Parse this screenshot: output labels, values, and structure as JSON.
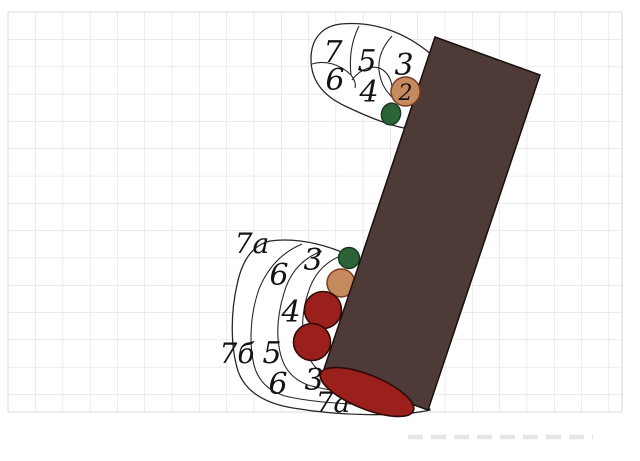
{
  "canvas": {
    "width": 640,
    "height": 461
  },
  "colors": {
    "paper": "#ffffff",
    "grid_line": "#d9d9db",
    "figure_outline": "#2b2625",
    "rectangle_fill": "#4e3a37",
    "red_fill": "#9b1f1a",
    "tan_fill": "#c58a5e",
    "green_fill": "#2c6337",
    "label_ink": "#151312",
    "watermark": "#e6e6e6"
  },
  "top_diagram": {
    "labels": [
      "7",
      "6",
      "5",
      "4",
      "3"
    ],
    "badge_label": "2"
  },
  "bottom_diagram": {
    "labels": [
      "7a",
      "3",
      "6",
      "4",
      "5",
      "7б",
      "6",
      "3",
      "7a"
    ]
  }
}
